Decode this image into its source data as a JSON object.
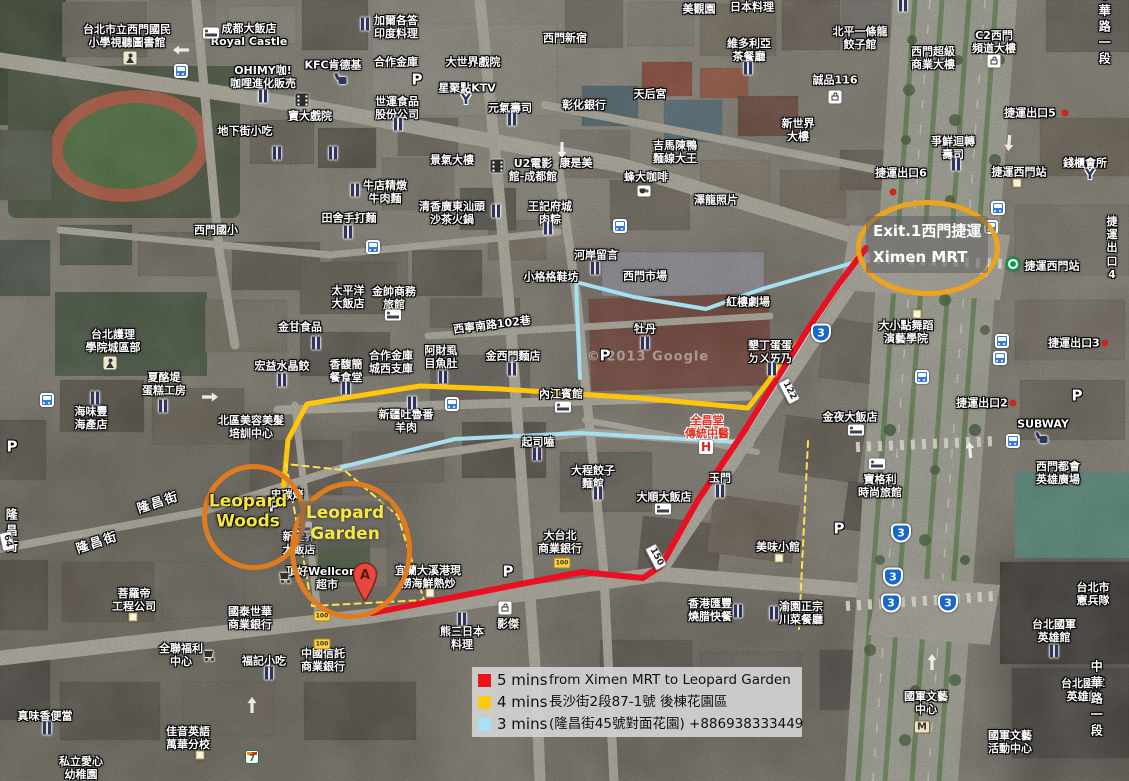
{
  "legend": {
    "items": [
      {
        "color": "#e8151d",
        "time": "5 mins",
        "desc": "from Ximen MRT to Leopard Garden"
      },
      {
        "color": "#ffc811",
        "time": "4 mins",
        "desc": "長沙街2段87-1號 後棟花園區"
      },
      {
        "color": "#a5e2f3",
        "time": "3 mins",
        "desc": "(隆昌街45號對面花園) +886938333449"
      }
    ]
  },
  "annotations": {
    "mrt": {
      "text": "Exit.1西門捷運\nXimen MRT"
    },
    "woods": {
      "text": "Leopard\nWoods"
    },
    "garden": {
      "text": "Leopard\nGarden"
    },
    "marker_a": "A",
    "watermark": "© 2013 Google"
  },
  "routes": [
    {
      "name": "cyan-alt",
      "color": "#a5dff0",
      "width": 4,
      "points": [
        [
          856,
          262
        ],
        [
          762,
          289
        ],
        [
          706,
          309
        ],
        [
          634,
          297
        ],
        [
          576,
          282
        ],
        [
          580,
          378
        ]
      ]
    },
    {
      "name": "cyan-main",
      "color": "#a5dff0",
      "width": 4,
      "points": [
        [
          863,
          250
        ],
        [
          810,
          330
        ],
        [
          750,
          425
        ],
        [
          735,
          442
        ],
        [
          580,
          433
        ],
        [
          455,
          439
        ],
        [
          342,
          467
        ]
      ]
    },
    {
      "name": "yellow-main",
      "color": "#ffc60a",
      "width": 5,
      "points": [
        [
          860,
          254
        ],
        [
          808,
          330
        ],
        [
          748,
          408
        ],
        [
          640,
          398
        ],
        [
          500,
          389
        ],
        [
          420,
          386
        ],
        [
          307,
          404
        ],
        [
          288,
          440
        ],
        [
          283,
          493
        ]
      ]
    },
    {
      "name": "yellow-boundary",
      "color": "#ffe14a",
      "width": 2,
      "dash": "6 5",
      "points": [
        [
          286,
          464
        ],
        [
          312,
          606
        ],
        [
          424,
          600
        ],
        [
          398,
          516
        ],
        [
          344,
          470
        ],
        [
          286,
          464
        ]
      ]
    },
    {
      "name": "yellow-boundary-2",
      "color": "#ffe14a",
      "width": 2,
      "dash": "6 5",
      "points": [
        [
          808,
          441
        ],
        [
          799,
          629
        ]
      ]
    },
    {
      "name": "red-main",
      "color": "#ea1021",
      "width": 6,
      "points": [
        [
          866,
          248
        ],
        [
          838,
          285
        ],
        [
          806,
          332
        ],
        [
          745,
          430
        ],
        [
          698,
          500
        ],
        [
          661,
          566
        ],
        [
          643,
          578
        ],
        [
          582,
          572
        ],
        [
          470,
          594
        ],
        [
          372,
          613
        ]
      ]
    }
  ],
  "map": {
    "labels": [
      {
        "t": "台北市立西門國民\n小學視聽圖書館",
        "x": 127,
        "y": 36
      },
      {
        "t": "成都大飯店\nRoyal Castle",
        "x": 249,
        "y": 35
      },
      {
        "t": "OHIMY咖!\n咖哩進化販売",
        "x": 263,
        "y": 77
      },
      {
        "t": "地下街小吃",
        "x": 245,
        "y": 131
      },
      {
        "t": "加爾各答\n印度料理",
        "x": 396,
        "y": 27
      },
      {
        "t": "KFC肯德基",
        "x": 333,
        "y": 65
      },
      {
        "t": "合作金庫",
        "x": 396,
        "y": 62
      },
      {
        "t": "大世界戲院",
        "x": 473,
        "y": 62
      },
      {
        "t": "星聚點KTV",
        "x": 467,
        "y": 88
      },
      {
        "t": "世運食品\n股份公司",
        "x": 397,
        "y": 108
      },
      {
        "t": "元氣壽司",
        "x": 510,
        "y": 108
      },
      {
        "t": "寶大戲院",
        "x": 310,
        "y": 116
      },
      {
        "t": "西門新宿",
        "x": 565,
        "y": 38
      },
      {
        "t": "美觀園",
        "x": 699,
        "y": 9
      },
      {
        "t": "日本料理",
        "x": 752,
        "y": 7
      },
      {
        "t": "維多利亞\n茶餐廳",
        "x": 749,
        "y": 50
      },
      {
        "t": "彰化銀行",
        "x": 584,
        "y": 105
      },
      {
        "t": "天后宮",
        "x": 650,
        "y": 94
      },
      {
        "t": "誠品116",
        "x": 835,
        "y": 80
      },
      {
        "t": "新世界\n大樓",
        "x": 798,
        "y": 130
      },
      {
        "t": "北平一條龍\n餃子館",
        "x": 860,
        "y": 38
      },
      {
        "t": "C2西門\n頻道大樓",
        "x": 994,
        "y": 42
      },
      {
        "t": "西門超級\n商業大樓",
        "x": 933,
        "y": 58
      },
      {
        "t": "捷運出口5",
        "x": 1030,
        "y": 113
      },
      {
        "t": "中華路一段",
        "x": 1104,
        "y": 28,
        "type": "vert"
      },
      {
        "t": "錢櫃會所",
        "x": 1085,
        "y": 163
      },
      {
        "t": "爭鮮迴轉\n壽司",
        "x": 953,
        "y": 148
      },
      {
        "t": "捷運西門站",
        "x": 1019,
        "y": 172
      },
      {
        "t": "捷運出口6",
        "x": 901,
        "y": 173
      },
      {
        "t": "捷運西門站",
        "x": 1052,
        "y": 266
      },
      {
        "t": "捷運出口4",
        "x": 1112,
        "y": 248
      },
      {
        "t": "捷運出口3",
        "x": 1074,
        "y": 343
      },
      {
        "t": "捷運出口2",
        "x": 982,
        "y": 403
      },
      {
        "t": "SUBWAY",
        "x": 1043,
        "y": 424
      },
      {
        "t": "大小點舞蹈\n演藝學院",
        "x": 906,
        "y": 332
      },
      {
        "t": "西門都會\n英雄廣場",
        "x": 1058,
        "y": 473
      },
      {
        "t": "寶格利\n時尚旅館",
        "x": 880,
        "y": 486
      },
      {
        "t": "金夜大飯店",
        "x": 850,
        "y": 417
      },
      {
        "t": "台北市\n憲兵隊",
        "x": 1093,
        "y": 594
      },
      {
        "t": "台北國軍\n英雄館",
        "x": 1054,
        "y": 631
      },
      {
        "t": "台北國軍\n英雄館",
        "x": 1083,
        "y": 690
      },
      {
        "t": "國軍文藝\n中心",
        "x": 926,
        "y": 703
      },
      {
        "t": "國軍文藝\n活動中心",
        "x": 1010,
        "y": 742
      },
      {
        "t": "景氣大樓",
        "x": 452,
        "y": 160
      },
      {
        "t": "U2電影\n館-成都館",
        "x": 533,
        "y": 170
      },
      {
        "t": "康是美",
        "x": 576,
        "y": 163
      },
      {
        "t": "蜂大咖啡",
        "x": 646,
        "y": 177
      },
      {
        "t": "吉馬陳鴨\n麵線大王",
        "x": 675,
        "y": 152
      },
      {
        "t": "澤龍照片",
        "x": 716,
        "y": 200
      },
      {
        "t": "牛店精燉\n牛肉麵",
        "x": 385,
        "y": 192
      },
      {
        "t": "清香廣東汕頭\n沙茶火鍋",
        "x": 452,
        "y": 213
      },
      {
        "t": "田舍手打麵",
        "x": 349,
        "y": 218
      },
      {
        "t": "西門國小",
        "x": 216,
        "y": 230
      },
      {
        "t": "王記府城\n肉粽",
        "x": 550,
        "y": 213
      },
      {
        "t": "河岸留言",
        "x": 596,
        "y": 255
      },
      {
        "t": "西門市場",
        "x": 645,
        "y": 276
      },
      {
        "t": "小格格鞋坊",
        "x": 551,
        "y": 277
      },
      {
        "t": "紅樓劇場",
        "x": 748,
        "y": 302
      },
      {
        "t": "牡丹",
        "x": 645,
        "y": 329
      },
      {
        "t": "墾丁蛋蛋\nㄉㄨㄞ乃",
        "x": 770,
        "y": 352
      },
      {
        "t": "全昌堂\n傳統中醫",
        "x": 707,
        "y": 427,
        "type": "red"
      },
      {
        "t": "太平洋\n大飯店",
        "x": 348,
        "y": 297
      },
      {
        "t": "金帥商務\n旅館",
        "x": 394,
        "y": 298
      },
      {
        "t": "西寧南路102巷",
        "x": 492,
        "y": 325,
        "rot": -7
      },
      {
        "t": "金甘食品",
        "x": 300,
        "y": 327
      },
      {
        "t": "合作金庫\n城西支庫",
        "x": 391,
        "y": 362
      },
      {
        "t": "阿財虱\n目魚肚",
        "x": 441,
        "y": 357
      },
      {
        "t": "金西門麵店",
        "x": 513,
        "y": 356
      },
      {
        "t": "香馥簡\n餐食堂",
        "x": 346,
        "y": 371
      },
      {
        "t": "宏益水晶餃",
        "x": 282,
        "y": 366
      },
      {
        "t": "內江賓館",
        "x": 561,
        "y": 394
      },
      {
        "t": "新疆吐魯番\n羊肉",
        "x": 406,
        "y": 421
      },
      {
        "t": "起司嗑",
        "x": 538,
        "y": 442
      },
      {
        "t": "北區美容美髮\n培訓中心",
        "x": 251,
        "y": 427
      },
      {
        "t": "台北護理\n學院城區部",
        "x": 113,
        "y": 341
      },
      {
        "t": "夏酪堤\n蛋糕工房",
        "x": 164,
        "y": 384
      },
      {
        "t": "海味豐\n海產店",
        "x": 91,
        "y": 418
      },
      {
        "t": "隆昌街",
        "x": 158,
        "y": 502,
        "rot": -18,
        "type": "street"
      },
      {
        "t": "隆昌街",
        "x": 97,
        "y": 542,
        "rot": -18,
        "type": "street"
      },
      {
        "t": "隆昌街",
        "x": 11,
        "y": 532,
        "type": "vert"
      },
      {
        "t": "忠碳烤",
        "x": 287,
        "y": 495
      },
      {
        "t": "新仕界\n大飯店",
        "x": 299,
        "y": 543
      },
      {
        "t": "頂好Wellcome\n超市",
        "x": 327,
        "y": 578
      },
      {
        "t": "宜蘭大溪港現\n撈海鮮熱炒",
        "x": 428,
        "y": 577
      },
      {
        "t": "大台北\n商業銀行",
        "x": 560,
        "y": 542
      },
      {
        "t": "大程餃子\n麵館",
        "x": 593,
        "y": 477
      },
      {
        "t": "大順大飯店",
        "x": 664,
        "y": 497
      },
      {
        "t": "玉門",
        "x": 720,
        "y": 478
      },
      {
        "t": "美味小館",
        "x": 778,
        "y": 547
      },
      {
        "t": "影傑",
        "x": 508,
        "y": 624
      },
      {
        "t": "熊三日本\n料理",
        "x": 462,
        "y": 638
      },
      {
        "t": "香港匯豐\n燒腊快餐",
        "x": 710,
        "y": 610
      },
      {
        "t": "渝園正宗\n川菜餐廳",
        "x": 801,
        "y": 613
      },
      {
        "t": "菩羅帝\n工程公司",
        "x": 134,
        "y": 600
      },
      {
        "t": "國泰世華\n商業銀行",
        "x": 250,
        "y": 618
      },
      {
        "t": "中國信託\n商業銀行",
        "x": 323,
        "y": 660
      },
      {
        "t": "全聯福利\n中心",
        "x": 181,
        "y": 655
      },
      {
        "t": "福記小吃",
        "x": 264,
        "y": 661
      },
      {
        "t": "真味香便當",
        "x": 45,
        "y": 716
      },
      {
        "t": "佳音英語\n萬華分校",
        "x": 188,
        "y": 738
      },
      {
        "t": "私立愛心\n幼稚園",
        "x": 81,
        "y": 768
      },
      {
        "t": "中華路一段",
        "x": 1096,
        "y": 700,
        "type": "vert"
      }
    ],
    "icons": [
      {
        "k": "food",
        "x": 263,
        "y": 96
      },
      {
        "k": "food",
        "x": 365,
        "y": 24
      },
      {
        "k": "food",
        "x": 398,
        "y": 124
      },
      {
        "k": "food",
        "x": 512,
        "y": 119
      },
      {
        "k": "food",
        "x": 748,
        "y": 68
      },
      {
        "k": "food",
        "x": 903,
        "y": 5
      },
      {
        "k": "food",
        "x": 355,
        "y": 190
      },
      {
        "k": "food",
        "x": 348,
        "y": 232
      },
      {
        "k": "food",
        "x": 496,
        "y": 211
      },
      {
        "k": "food",
        "x": 548,
        "y": 228
      },
      {
        "k": "food",
        "x": 595,
        "y": 268
      },
      {
        "k": "food",
        "x": 645,
        "y": 343
      },
      {
        "k": "food",
        "x": 772,
        "y": 369
      },
      {
        "k": "food",
        "x": 316,
        "y": 343
      },
      {
        "k": "food",
        "x": 443,
        "y": 377
      },
      {
        "k": "food",
        "x": 512,
        "y": 369
      },
      {
        "k": "food",
        "x": 346,
        "y": 388
      },
      {
        "k": "food",
        "x": 412,
        "y": 403
      },
      {
        "k": "food",
        "x": 282,
        "y": 380
      },
      {
        "k": "food",
        "x": 537,
        "y": 454
      },
      {
        "k": "food",
        "x": 598,
        "y": 493
      },
      {
        "k": "food",
        "x": 720,
        "y": 491
      },
      {
        "k": "food",
        "x": 738,
        "y": 611
      },
      {
        "k": "food",
        "x": 774,
        "y": 613
      },
      {
        "k": "food",
        "x": 462,
        "y": 619
      },
      {
        "k": "food",
        "x": 269,
        "y": 673
      },
      {
        "k": "food",
        "x": 47,
        "y": 728
      },
      {
        "k": "food",
        "x": 163,
        "y": 406
      },
      {
        "k": "food",
        "x": 95,
        "y": 398
      },
      {
        "k": "food",
        "x": 277,
        "y": 153
      },
      {
        "k": "food",
        "x": 333,
        "y": 153
      },
      {
        "k": "food",
        "x": 956,
        "y": 164
      },
      {
        "k": "food",
        "x": 1054,
        "y": 651
      },
      {
        "k": "bus",
        "x": 181,
        "y": 71
      },
      {
        "k": "bus",
        "x": 620,
        "y": 226
      },
      {
        "k": "bus",
        "x": 373,
        "y": 247
      },
      {
        "k": "bus",
        "x": 452,
        "y": 404
      },
      {
        "k": "bus",
        "x": 47,
        "y": 400
      },
      {
        "k": "bus",
        "x": 998,
        "y": 208
      },
      {
        "k": "bus",
        "x": 991,
        "y": 227
      },
      {
        "k": "bus",
        "x": 1002,
        "y": 341
      },
      {
        "k": "bus",
        "x": 1000,
        "y": 358
      },
      {
        "k": "bus",
        "x": 922,
        "y": 377
      },
      {
        "k": "bus",
        "x": 1013,
        "y": 441
      },
      {
        "k": "bag",
        "x": 835,
        "y": 97
      },
      {
        "k": "bag",
        "x": 994,
        "y": 61
      },
      {
        "k": "bag",
        "x": 505,
        "y": 608
      },
      {
        "k": "bed",
        "x": 211,
        "y": 33
      },
      {
        "k": "bed",
        "x": 393,
        "y": 315
      },
      {
        "k": "bed",
        "x": 304,
        "y": 527
      },
      {
        "k": "bed",
        "x": 563,
        "y": 407
      },
      {
        "k": "bed",
        "x": 663,
        "y": 509
      },
      {
        "k": "bed",
        "x": 856,
        "y": 430
      },
      {
        "k": "bed",
        "x": 877,
        "y": 464
      },
      {
        "k": "p",
        "x": 417,
        "y": 80
      },
      {
        "k": "p",
        "x": 605,
        "y": 356
      },
      {
        "k": "p",
        "x": 508,
        "y": 572
      },
      {
        "k": "p",
        "x": 839,
        "y": 529
      },
      {
        "k": "p",
        "x": 1077,
        "y": 396
      },
      {
        "k": "p",
        "x": 12,
        "y": 447
      },
      {
        "k": "p",
        "x": 274,
        "y": 507
      },
      {
        "k": "h",
        "x": 706,
        "y": 447
      },
      {
        "k": "m",
        "x": 922,
        "y": 727
      },
      {
        "k": "martini",
        "x": 466,
        "y": 100
      },
      {
        "k": "martini",
        "x": 1090,
        "y": 175
      },
      {
        "k": "cup",
        "x": 644,
        "y": 191
      },
      {
        "k": "film",
        "x": 497,
        "y": 166
      },
      {
        "k": "film",
        "x": 302,
        "y": 100
      },
      {
        "k": "thumb",
        "x": 342,
        "y": 79
      },
      {
        "k": "thumb",
        "x": 1043,
        "y": 438
      },
      {
        "k": "cart",
        "x": 209,
        "y": 655
      },
      {
        "k": "cart",
        "x": 285,
        "y": 577
      },
      {
        "k": "school",
        "x": 130,
        "y": 58
      },
      {
        "k": "school",
        "x": 110,
        "y": 363
      },
      {
        "k": "ysq",
        "x": 917,
        "y": 314
      },
      {
        "k": "ysq",
        "x": 1017,
        "y": 183
      },
      {
        "k": "ysq",
        "x": 779,
        "y": 558
      },
      {
        "k": "ysq",
        "x": 430,
        "y": 593
      },
      {
        "k": "ysq",
        "x": 133,
        "y": 617
      },
      {
        "k": "ysq",
        "x": 200,
        "y": 755
      },
      {
        "k": "dot",
        "x": 1065,
        "y": 113
      },
      {
        "k": "dot",
        "x": 893,
        "y": 192
      },
      {
        "k": "dot",
        "x": 1105,
        "y": 343
      },
      {
        "k": "dot",
        "x": 1013,
        "y": 403
      },
      {
        "k": "mrt",
        "x": 1013,
        "y": 264
      },
      {
        "k": "sev",
        "x": 252,
        "y": 757
      },
      {
        "k": "tag",
        "x": 562,
        "y": 563
      },
      {
        "k": "tag",
        "x": 322,
        "y": 616
      },
      {
        "k": "tag",
        "x": 322,
        "y": 644
      },
      {
        "k": "sh3",
        "x": 901,
        "y": 533
      },
      {
        "k": "sh3",
        "x": 893,
        "y": 577
      },
      {
        "k": "sh3",
        "x": 891,
        "y": 603
      },
      {
        "k": "sh3",
        "x": 948,
        "y": 603
      },
      {
        "k": "sh3",
        "x": 821,
        "y": 333
      },
      {
        "k": "arrow",
        "x": 181,
        "y": 50,
        "r": 270
      },
      {
        "k": "arrow",
        "x": 562,
        "y": 150,
        "r": 180
      },
      {
        "k": "arrow",
        "x": 1009,
        "y": 143,
        "r": 185
      },
      {
        "k": "arrow",
        "x": 985,
        "y": 272,
        "r": 205
      },
      {
        "k": "arrow",
        "x": 210,
        "y": 397,
        "r": 90
      },
      {
        "k": "arrow",
        "x": 970,
        "y": 450,
        "r": 355
      },
      {
        "k": "arrow",
        "x": 932,
        "y": 662,
        "r": 0
      },
      {
        "k": "arrow",
        "x": 252,
        "y": 705,
        "r": 0
      }
    ],
    "shields": [
      {
        "t": "122",
        "x": 789,
        "y": 391,
        "rot": 62
      },
      {
        "t": "150",
        "x": 656,
        "y": 557,
        "rot": 62
      },
      {
        "t": "64",
        "x": 7,
        "y": 541,
        "rot": 78
      }
    ]
  }
}
